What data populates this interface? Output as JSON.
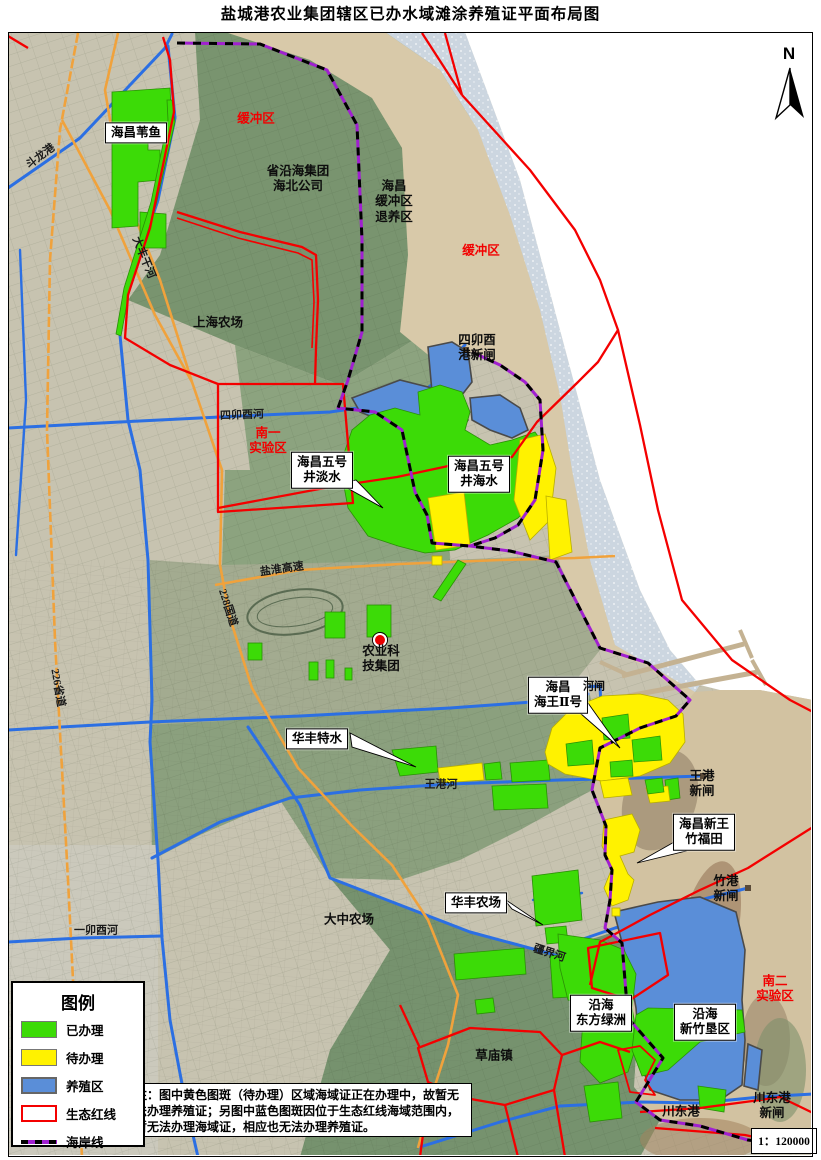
{
  "title": "盐城港农业集团辖区已办水域滩涂养殖证平面布局图",
  "compass": {
    "label": "N"
  },
  "scale": {
    "text": "1：120000"
  },
  "note": {
    "text": "注：图中黄色图斑（待办理）区域海域证正在办理中，故暂无法办理养殖证；另图中蓝色图斑因位于生态红线海域范围内，暂无法办理海域证，相应也无法办理养殖证。"
  },
  "legend": {
    "title": "图例",
    "items": [
      {
        "label": "已办理",
        "style": "fill",
        "color": "#3cdb07"
      },
      {
        "label": "待办理",
        "style": "fill",
        "color": "#fff200"
      },
      {
        "label": "养殖区",
        "style": "fill-border",
        "color": "#5a8ed8"
      },
      {
        "label": "生态红线",
        "style": "outline",
        "color": "#f40000"
      },
      {
        "label": "海岸线",
        "style": "coast-line",
        "color": "#a020d0"
      }
    ]
  },
  "map_labels": {
    "boxed": [
      {
        "id": "label-haichang-weiyu",
        "text": "海昌苇鱼",
        "x": 136,
        "y": 133
      },
      {
        "id": "label-haichang-no5-danshui",
        "text": "海昌五号\n井淡水",
        "x": 322,
        "y": 470
      },
      {
        "id": "label-haichang-no5-haishui",
        "text": "海昌五号\n井海水",
        "x": 479,
        "y": 474
      },
      {
        "id": "label-haichang-haiwang-2",
        "text": "海昌\n海王Ⅱ号",
        "x": 558,
        "y": 695
      },
      {
        "id": "label-huafeng-teshui",
        "text": "华丰特水",
        "x": 317,
        "y": 739
      },
      {
        "id": "label-huafeng-nongchang",
        "text": "华丰农场",
        "x": 476,
        "y": 903
      },
      {
        "id": "label-haichang-xinwang-zhufutian",
        "text": "海昌新王\n竹福田",
        "x": 704,
        "y": 832
      },
      {
        "id": "label-yanhai-dongfang-lvzhou",
        "text": "沿海\n东方绿洲",
        "x": 601,
        "y": 1013
      },
      {
        "id": "label-yanhai-xinzhu-kenqu",
        "text": "沿海\n新竹垦区",
        "x": 705,
        "y": 1022
      }
    ],
    "zones": [
      {
        "id": "label-huanchongqu-north",
        "text": "缓冲区",
        "x": 256,
        "y": 119
      },
      {
        "id": "label-huanchongqu-coast",
        "text": "缓冲区",
        "x": 481,
        "y": 251
      },
      {
        "id": "label-nanyi-shiyanqu",
        "text": "南一\n实验区",
        "x": 268,
        "y": 441
      },
      {
        "id": "label-naner-shiyanqu",
        "text": "南二\n实验区",
        "x": 775,
        "y": 989
      }
    ],
    "places": [
      {
        "id": "label-sheng-yanhai-jituan",
        "text": "省沿海集团\n海北公司",
        "x": 298,
        "y": 179
      },
      {
        "id": "label-haichang-tuiyangqu",
        "text": "海昌\n缓冲区\n退养区",
        "x": 394,
        "y": 202
      },
      {
        "id": "label-shanghai-nongchang",
        "text": "上海农场",
        "x": 218,
        "y": 323
      },
      {
        "id": "label-simaoyou-gang-xinzha",
        "text": "四卯酉\n港新闸",
        "x": 477,
        "y": 348
      },
      {
        "id": "label-nongye-keji-jituan",
        "text": "农业科\n技集团",
        "x": 381,
        "y": 659
      },
      {
        "id": "label-dazhong-nongchang",
        "text": "大中农场",
        "x": 349,
        "y": 920
      },
      {
        "id": "label-caomiao-zhen",
        "text": "草庙镇",
        "x": 494,
        "y": 1056
      },
      {
        "id": "label-wanggang-xinzha",
        "text": "王港\n新闸",
        "x": 702,
        "y": 784
      },
      {
        "id": "label-zhugang-xinzha",
        "text": "竹港\n新闸",
        "x": 726,
        "y": 889
      },
      {
        "id": "label-chuandonggang-xinzha",
        "text": "川东港\n新闸",
        "x": 772,
        "y": 1106
      },
      {
        "id": "label-chuandonggang",
        "text": "川东港",
        "x": 681,
        "y": 1112
      },
      {
        "id": "label-hezha",
        "text": "河闸",
        "x": 594,
        "y": 687,
        "fs": 11
      }
    ],
    "waterways": [
      {
        "id": "label-doulong-gang",
        "text": "斗龙港",
        "x": 41,
        "y": 157,
        "rot": -37
      },
      {
        "id": "label-dafeng-ganhe",
        "text": "大丰干河",
        "x": 143,
        "y": 258,
        "rot": 68
      },
      {
        "id": "label-simaoyou-he",
        "text": "四卯酉河",
        "x": 242,
        "y": 416,
        "rot": -2
      },
      {
        "id": "label-yimaoyou-he",
        "text": "一卯酉河",
        "x": 96,
        "y": 931,
        "rot": 0
      },
      {
        "id": "label-wanggang-he",
        "text": "王港河",
        "x": 441,
        "y": 785,
        "rot": 0
      },
      {
        "id": "label-jiangjie-he",
        "text": "疆界河",
        "x": 549,
        "y": 954,
        "rot": 18
      },
      {
        "id": "label-226-shengdao",
        "text": "226省道",
        "x": 57,
        "y": 688,
        "rot": 80
      },
      {
        "id": "label-228-guodao",
        "text": "228国道",
        "x": 227,
        "y": 608,
        "rot": 72
      },
      {
        "id": "label-yanhuai-gaosu",
        "text": "盐淮高速",
        "x": 282,
        "y": 570,
        "rot": -8
      }
    ]
  }
}
